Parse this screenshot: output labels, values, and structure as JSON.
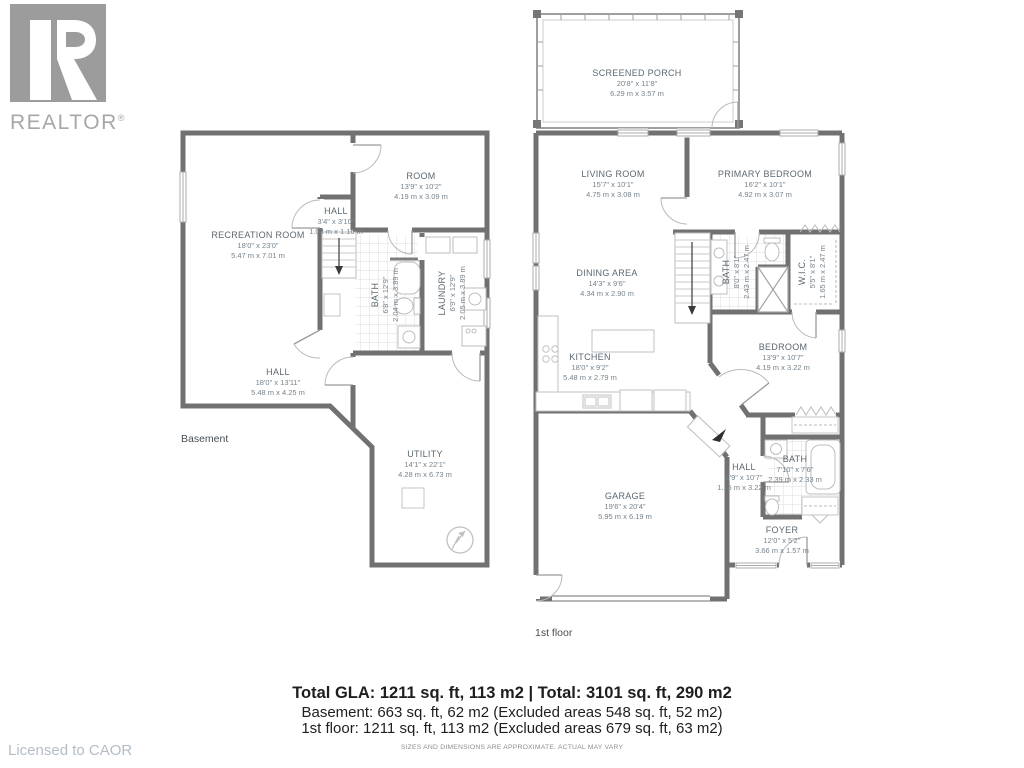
{
  "branding": {
    "logo_text": "REALTOR",
    "registered_mark": "®",
    "licensed_to": "Licensed to CAOR"
  },
  "floors": {
    "basement": {
      "label": "Basement",
      "rooms": [
        {
          "name": "RECREATION ROOM",
          "ft": "18'0\" x 23'0\"",
          "m": "5.47 m x 7.01 m"
        },
        {
          "name": "HALL",
          "ft": "3'4\" x 3'10\"",
          "m": "1.03 m x 1.16 m"
        },
        {
          "name": "ROOM",
          "ft": "13'9\" x 10'2\"",
          "m": "4.19 m x 3.09 m"
        },
        {
          "name": "BATH",
          "ft": "6'8\" x 12'9\"",
          "m": "2.04 m x 3.89 m"
        },
        {
          "name": "LAUNDRY",
          "ft": "6'9\" x 12'9\"",
          "m": "2.05 m x 3.89 m"
        },
        {
          "name": "HALL",
          "ft": "18'0\" x 13'11\"",
          "m": "5.48 m x 4.25 m"
        },
        {
          "name": "UTILITY",
          "ft": "14'1\" x 22'1\"",
          "m": "4.28 m x 6.73 m"
        }
      ]
    },
    "first": {
      "label": "1st floor",
      "rooms": [
        {
          "name": "SCREENED PORCH",
          "ft": "20'8\" x 11'8\"",
          "m": "6.29 m x 3.57 m"
        },
        {
          "name": "LIVING ROOM",
          "ft": "15'7\" x 10'1\"",
          "m": "4.75 m x 3.08 m"
        },
        {
          "name": "PRIMARY BEDROOM",
          "ft": "16'2\" x 10'1\"",
          "m": "4.92 m x 3.07 m"
        },
        {
          "name": "DINING AREA",
          "ft": "14'3\" x 9'6\"",
          "m": "4.34 m x 2.90 m"
        },
        {
          "name": "BATH",
          "ft": "8'0\" x 8'1\"",
          "m": "2.43 m x 2.47 m"
        },
        {
          "name": "W.I.C.",
          "ft": "5'5\" x 8'1\"",
          "m": "1.65 m x 2.47 m"
        },
        {
          "name": "KITCHEN",
          "ft": "18'0\" x 9'2\"",
          "m": "5.48 m x 2.79 m"
        },
        {
          "name": "BEDROOM",
          "ft": "13'9\" x 10'7\"",
          "m": "4.19 m x 3.22 m"
        },
        {
          "name": "HALL",
          "ft": "3'9\" x 10'7\"",
          "m": "1.15 m x 3.22 m"
        },
        {
          "name": "BATH",
          "ft": "7'10\" x 7'6\"",
          "m": "2.39 m x 2.33 m"
        },
        {
          "name": "GARAGE",
          "ft": "19'6\" x 20'4\"",
          "m": "5.95 m x 6.19 m"
        },
        {
          "name": "FOYER",
          "ft": "12'0\" x 5'2\"",
          "m": "3.66 m x 1.57 m"
        }
      ]
    }
  },
  "summary": {
    "line1": "Total GLA: 1211 sq. ft, 113 m2 | Total: 3101 sq. ft, 290 m2",
    "line2": "Basement: 663 sq. ft, 62 m2 (Excluded areas 548 sq. ft, 52 m2)",
    "line3": "1st floor: 1211 sq. ft, 113 m2 (Excluded areas 679 sq. ft, 63 m2)",
    "disclaimer": "SIZES AND DIMENSIONS ARE APPROXIMATE. ACTUAL MAY VARY"
  }
}
